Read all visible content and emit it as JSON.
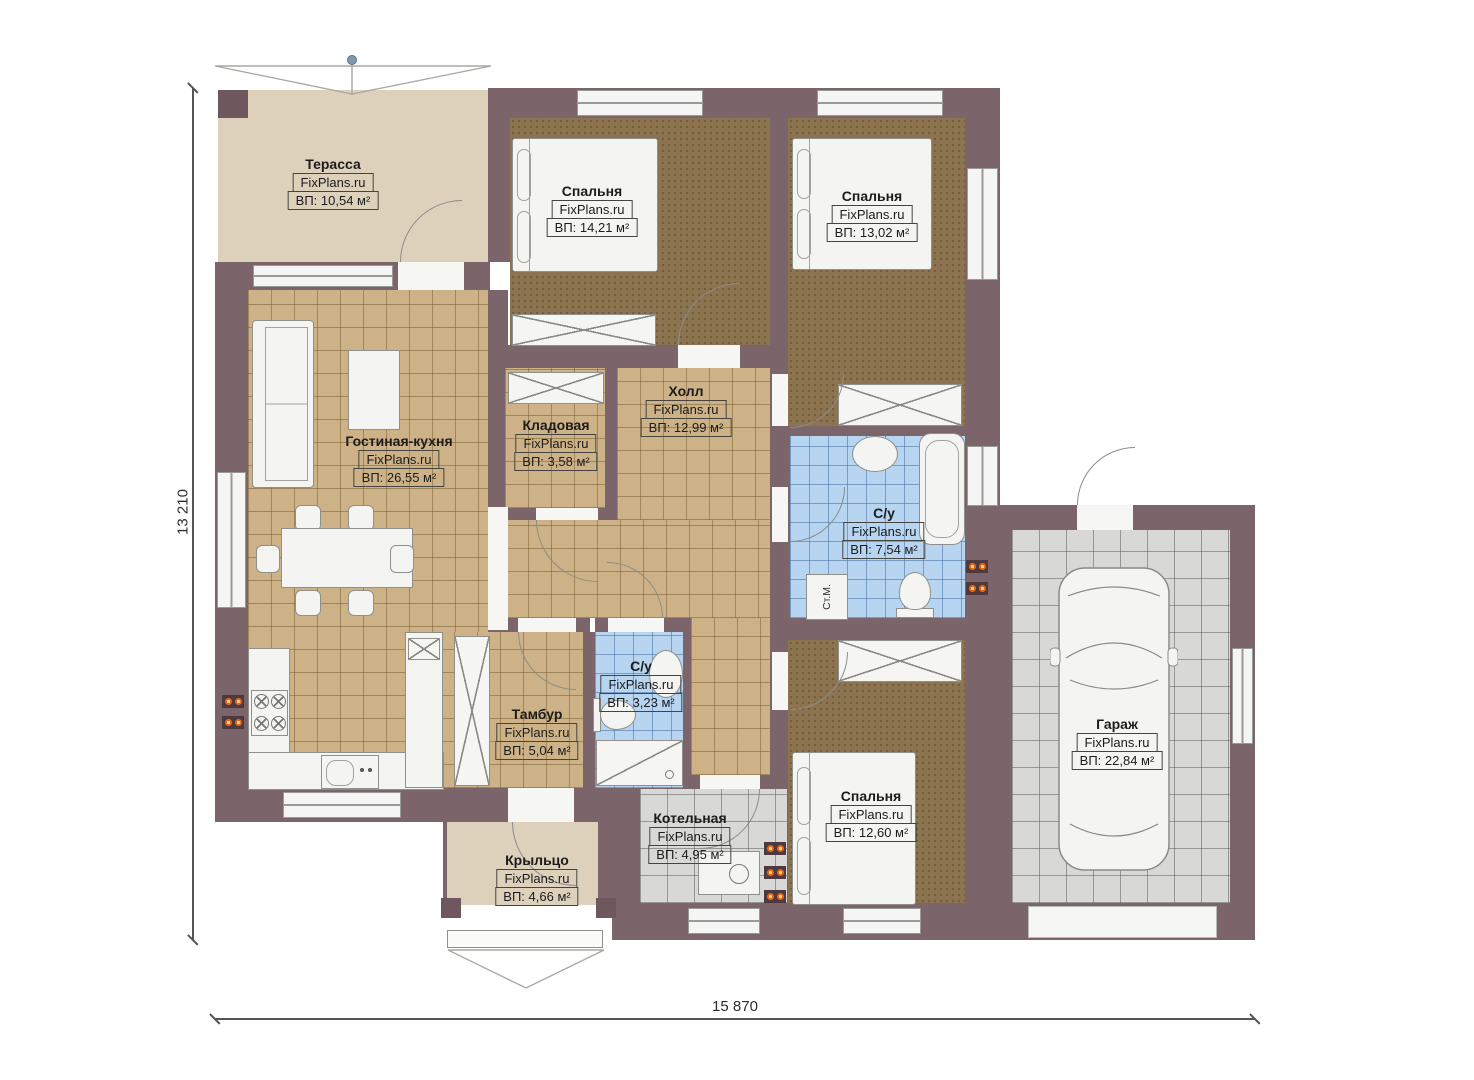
{
  "watermark": "FixPlans.ru",
  "dimensions": {
    "width_mm": "15 870",
    "height_mm": "13 210"
  },
  "area_prefix": "ВП:",
  "rooms": [
    {
      "id": "terrace",
      "name": "Терасса",
      "area": "ВП: 10,54 м²"
    },
    {
      "id": "bedroom-1",
      "name": "Спальня",
      "area": "ВП: 14,21 м²"
    },
    {
      "id": "bedroom-2",
      "name": "Спальня",
      "area": "ВП: 13,02 м²"
    },
    {
      "id": "living-kitchen",
      "name": "Гостиная-кухня",
      "area": "ВП: 26,55 м²"
    },
    {
      "id": "storage",
      "name": "Кладовая",
      "area": "ВП: 3,58 м²"
    },
    {
      "id": "hall",
      "name": "Холл",
      "area": "ВП: 12,99 м²"
    },
    {
      "id": "bathroom-main",
      "name": "С/у",
      "area": "ВП: 7,54 м²"
    },
    {
      "id": "tambour",
      "name": "Тамбур",
      "area": "ВП: 5,04 м²"
    },
    {
      "id": "bathroom-small",
      "name": "С/у",
      "area": "ВП: 3,23 м²"
    },
    {
      "id": "boiler-room",
      "name": "Котельная",
      "area": "ВП: 4,95 м²"
    },
    {
      "id": "bedroom-3",
      "name": "Спальня",
      "area": "ВП: 12,60 м²"
    },
    {
      "id": "garage",
      "name": "Гараж",
      "area": "ВП: 22,84 м²"
    },
    {
      "id": "porch",
      "name": "Крыльцо",
      "area": "ВП: 4,66 м²"
    }
  ],
  "fixtures": {
    "washing_machine_label": "Ст.М."
  },
  "colors": {
    "wall": "#7b646a",
    "tile_beige": "#cdb287",
    "tile_blue": "#b7d4f1",
    "tile_grey": "#d8d8d7",
    "carpet": "#8d7450",
    "terrace_floor": "#ddd1bb",
    "radiator": "#e06a1e"
  }
}
